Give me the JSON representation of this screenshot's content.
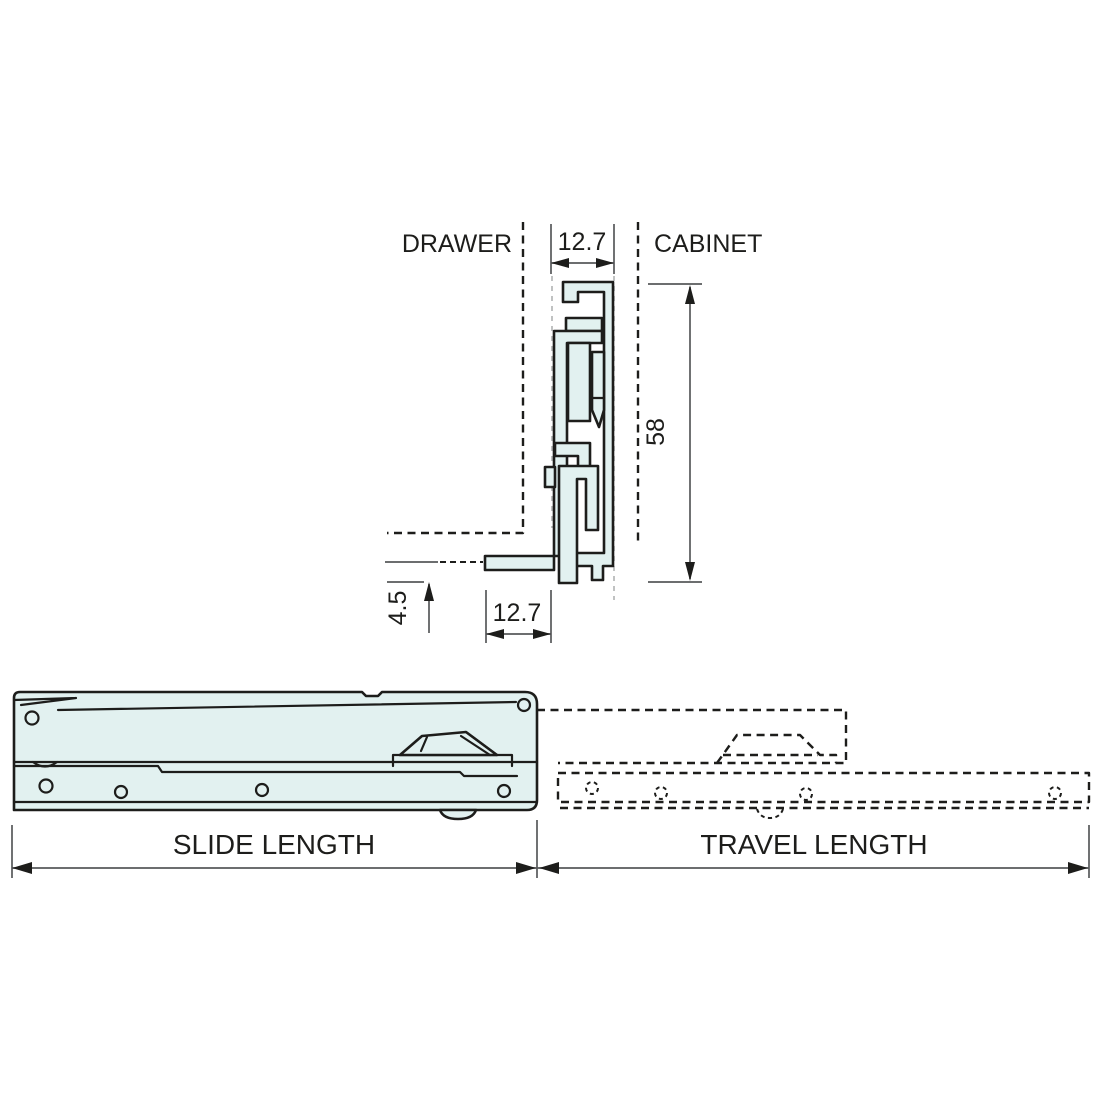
{
  "diagram_title": "drawer-slide-dimensional-diagram",
  "colors": {
    "part_fill": "#e2f1f0",
    "outline": "#1d1d1b",
    "dim_line": "#58595b",
    "guide_dash": "#b5b8b8"
  },
  "cross_section": {
    "drawer_label": "DRAWER",
    "cabinet_label": "CABINET",
    "dimensions": {
      "slide_width_top": "12.7",
      "slide_height": "58",
      "flange_drop": "4.5",
      "flange_width_bottom": "12.7"
    }
  },
  "side_view": {
    "dimensions": {
      "slide_length": "SLIDE LENGTH",
      "travel_length": "TRAVEL LENGTH"
    }
  }
}
